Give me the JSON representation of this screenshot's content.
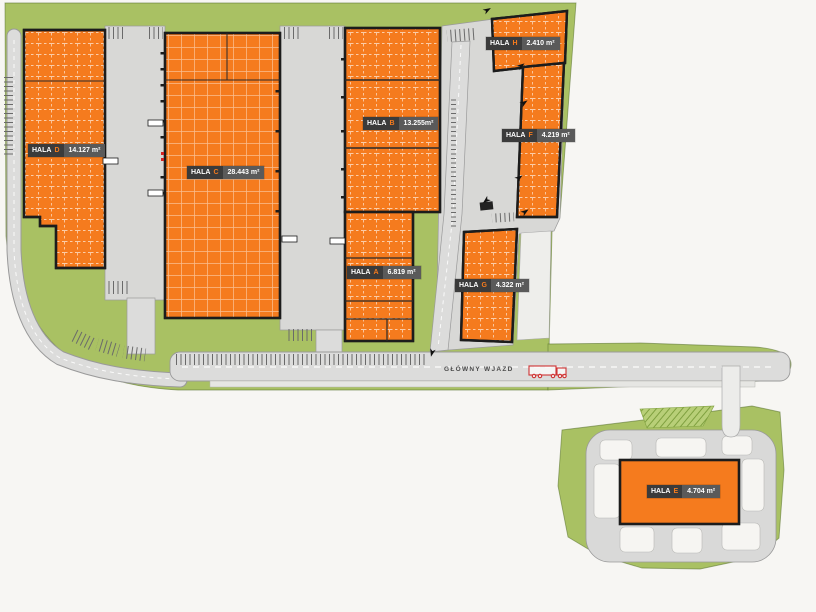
{
  "site": {
    "type": "industrial-park-site-plan",
    "road": {
      "main_entrance_label": "GŁÓWNY WJAZD"
    },
    "halls": [
      {
        "label": "HALA",
        "letter": "D",
        "area": "14.127 m²"
      },
      {
        "label": "HALA",
        "letter": "C",
        "area": "28.443 m²"
      },
      {
        "label": "HALA",
        "letter": "B",
        "area": "13.255m²"
      },
      {
        "label": "HALA",
        "letter": "A",
        "area": "6.819 m²"
      },
      {
        "label": "HALA",
        "letter": "H",
        "area": "2.410 m²"
      },
      {
        "label": "HALA",
        "letter": "F",
        "area": "4.219 m²"
      },
      {
        "label": "HALA",
        "letter": "G",
        "area": "4.322 m²"
      },
      {
        "label": "HALA",
        "letter": "E",
        "area": "4.704 m²"
      }
    ],
    "colors": {
      "hall_fill": "#f57b1e",
      "site_green": "#a9c163",
      "road_gray": "#dcdcdb",
      "apron_gray": "#d8d8d6",
      "label_dark": "#3b3b3b",
      "label_gray": "#5a5a5a",
      "truck_red": "#cf3333",
      "background": "#f7f6f3"
    }
  }
}
